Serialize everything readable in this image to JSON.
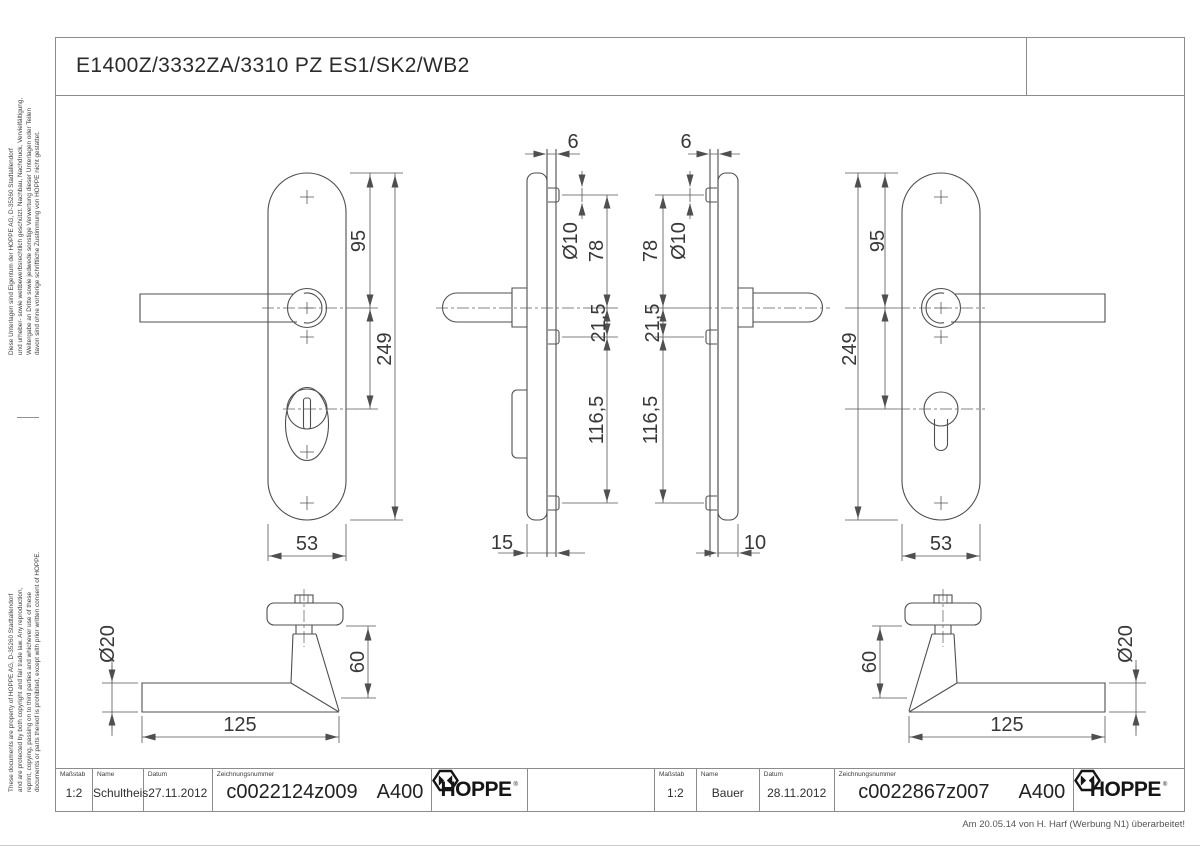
{
  "drawing": {
    "title": "E1400Z/3332ZA/3310 PZ ES1/SK2/WB2",
    "side_notes": {
      "german": [
        "Diese Unterlagen sind Eigentum der  HOPPE AG, D-35260 Stadtallendorf",
        "und urheber- sowie wettbewerbsrechtlich geschützt. Nachbau, Nachdruck, Vervielfältigung,",
        "Weitergabe an Dritte sowie jedwede sonstige Verwertung dieser Unterlagen oder Teilen",
        "davon sind ohne vorherige schriftliche Zustimmung von HOPPE nicht gestattet."
      ],
      "english": [
        "These documents are property of HOPPE AG, D-35260 Stadtallendorf",
        "and are protected by both copyright and fair trade law. Any reproduction,",
        "reprint, copying, passing on to third parties and whichever use of these",
        "documents or parts thereof is prohibited, except with prior written consent of HOPPE."
      ]
    },
    "dims": {
      "plate_left": {
        "d95": "95",
        "d249": "249",
        "d53": "53"
      },
      "profile_left": {
        "d6": "6",
        "d10mm": "Ø10",
        "d78": "78",
        "d21": "21,5",
        "d116": "116,5",
        "d15": "15"
      },
      "profile_right": {
        "d6": "6",
        "d10mm": "Ø10",
        "d78": "78",
        "d21": "21,5",
        "d116": "116,5",
        "d10": "10"
      },
      "plate_right": {
        "d95": "95",
        "d249": "249",
        "d53": "53"
      },
      "lever_left": {
        "dia": "Ø20",
        "h": "60",
        "len": "125"
      },
      "lever_right": {
        "dia": "Ø20",
        "h": "60",
        "len": "125"
      }
    }
  },
  "title_blocks": {
    "labels": {
      "scale": "Maßstab",
      "name": "Name",
      "date": "Datum",
      "number": "Zeichnungsnummer"
    },
    "left": {
      "scale": "1:2",
      "name": "Schultheis",
      "date": "27.11.2012",
      "number": "c0022124z009",
      "code": "A400",
      "brand": "HOPPE",
      "reg": "®"
    },
    "right": {
      "scale": "1:2",
      "name": "Bauer",
      "date": "28.11.2012",
      "number": "c0022867z007",
      "code": "A400",
      "brand": "HOPPE",
      "reg": "®"
    }
  },
  "footer": {
    "revision_note": "Am 20.05.14 von H. Harf (Werbung N1) überarbeitet!"
  }
}
